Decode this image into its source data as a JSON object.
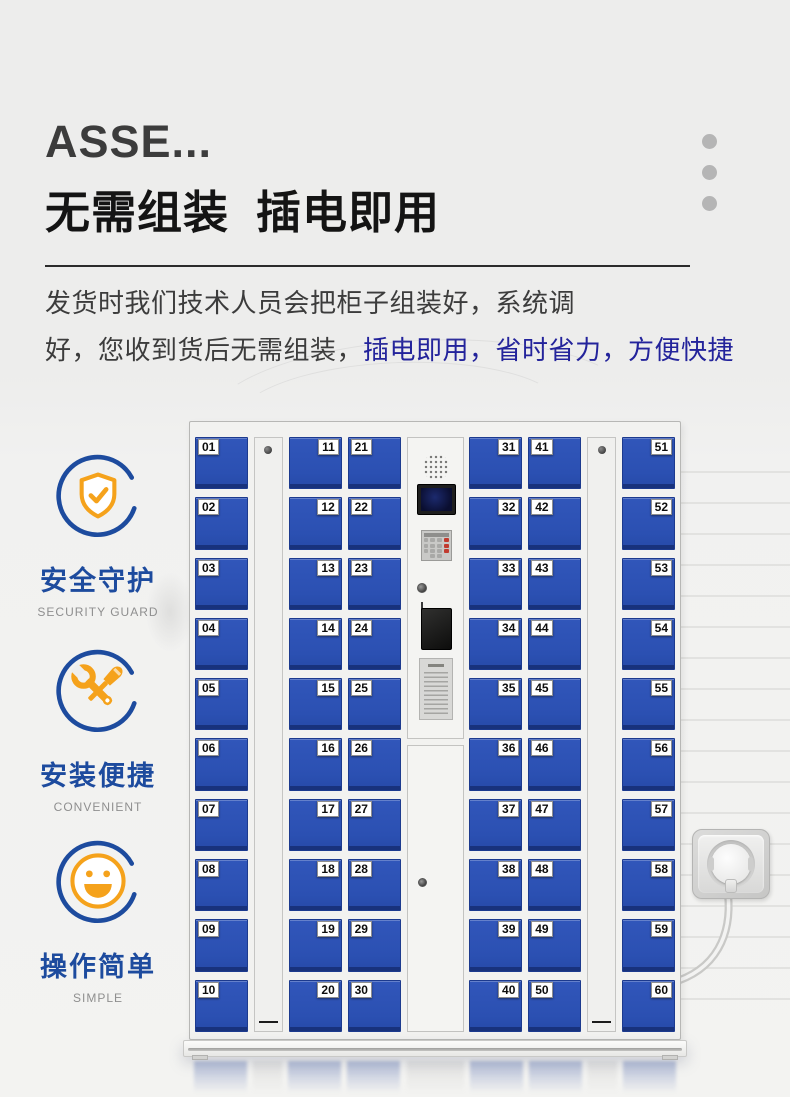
{
  "header": {
    "title_en": "ASSE...",
    "title_cn": "无需组装  插电即用",
    "paragraph": {
      "line1": "发货时我们技术人员会把柜子组装好，系统调",
      "line2_gray": "好，您收到货后无需组装，",
      "line2_blue": "插电即用，省时省力，方便快捷"
    }
  },
  "features": [
    {
      "icon": "shield-check-icon",
      "label_cn": "安全守护",
      "label_en": "SECURITY GUARD"
    },
    {
      "icon": "tools-icon",
      "label_cn": "安装便捷",
      "label_en": "CONVENIENT"
    },
    {
      "icon": "smiley-icon",
      "label_cn": "操作简单",
      "label_en": "SIMPLE"
    }
  ],
  "colors": {
    "accent_blue": "#1d4b9e",
    "accent_orange": "#f5a21b",
    "highlight_text_blue": "#23239b",
    "text_dark": "#3c3c3c",
    "door_blue": "#2b51b4",
    "page_bg": "#ededec"
  },
  "icons": {
    "shield-check-icon": "shield with checkmark inside open ring",
    "tools-icon": "crossed screwdriver and wrench inside open ring",
    "smiley-icon": "smiling face inside open ring",
    "speaker-icon": "speaker grille dots",
    "lock-icon": "keyhole lock",
    "socket-icon": "wall power socket with plug and cable"
  },
  "locker": {
    "columns": [
      {
        "type": "doors",
        "side": "left",
        "numbers": [
          "01",
          "02",
          "03",
          "04",
          "05",
          "06",
          "07",
          "08",
          "09",
          "10"
        ]
      },
      {
        "type": "strip"
      },
      {
        "type": "doors",
        "side": "right",
        "numbers": [
          "11",
          "12",
          "13",
          "14",
          "15",
          "16",
          "17",
          "18",
          "19",
          "20"
        ]
      },
      {
        "type": "doors",
        "side": "left",
        "numbers": [
          "21",
          "22",
          "23",
          "24",
          "25",
          "26",
          "27",
          "28",
          "29",
          "30"
        ]
      },
      {
        "type": "control"
      },
      {
        "type": "doors",
        "side": "right",
        "numbers": [
          "31",
          "32",
          "33",
          "34",
          "35",
          "36",
          "37",
          "38",
          "39",
          "40"
        ]
      },
      {
        "type": "doors",
        "side": "left",
        "numbers": [
          "41",
          "42",
          "43",
          "44",
          "45",
          "46",
          "47",
          "48",
          "49",
          "50"
        ]
      },
      {
        "type": "strip"
      },
      {
        "type": "doors",
        "side": "right",
        "numbers": [
          "51",
          "52",
          "53",
          "54",
          "55",
          "56",
          "57",
          "58",
          "59",
          "60"
        ]
      }
    ]
  }
}
